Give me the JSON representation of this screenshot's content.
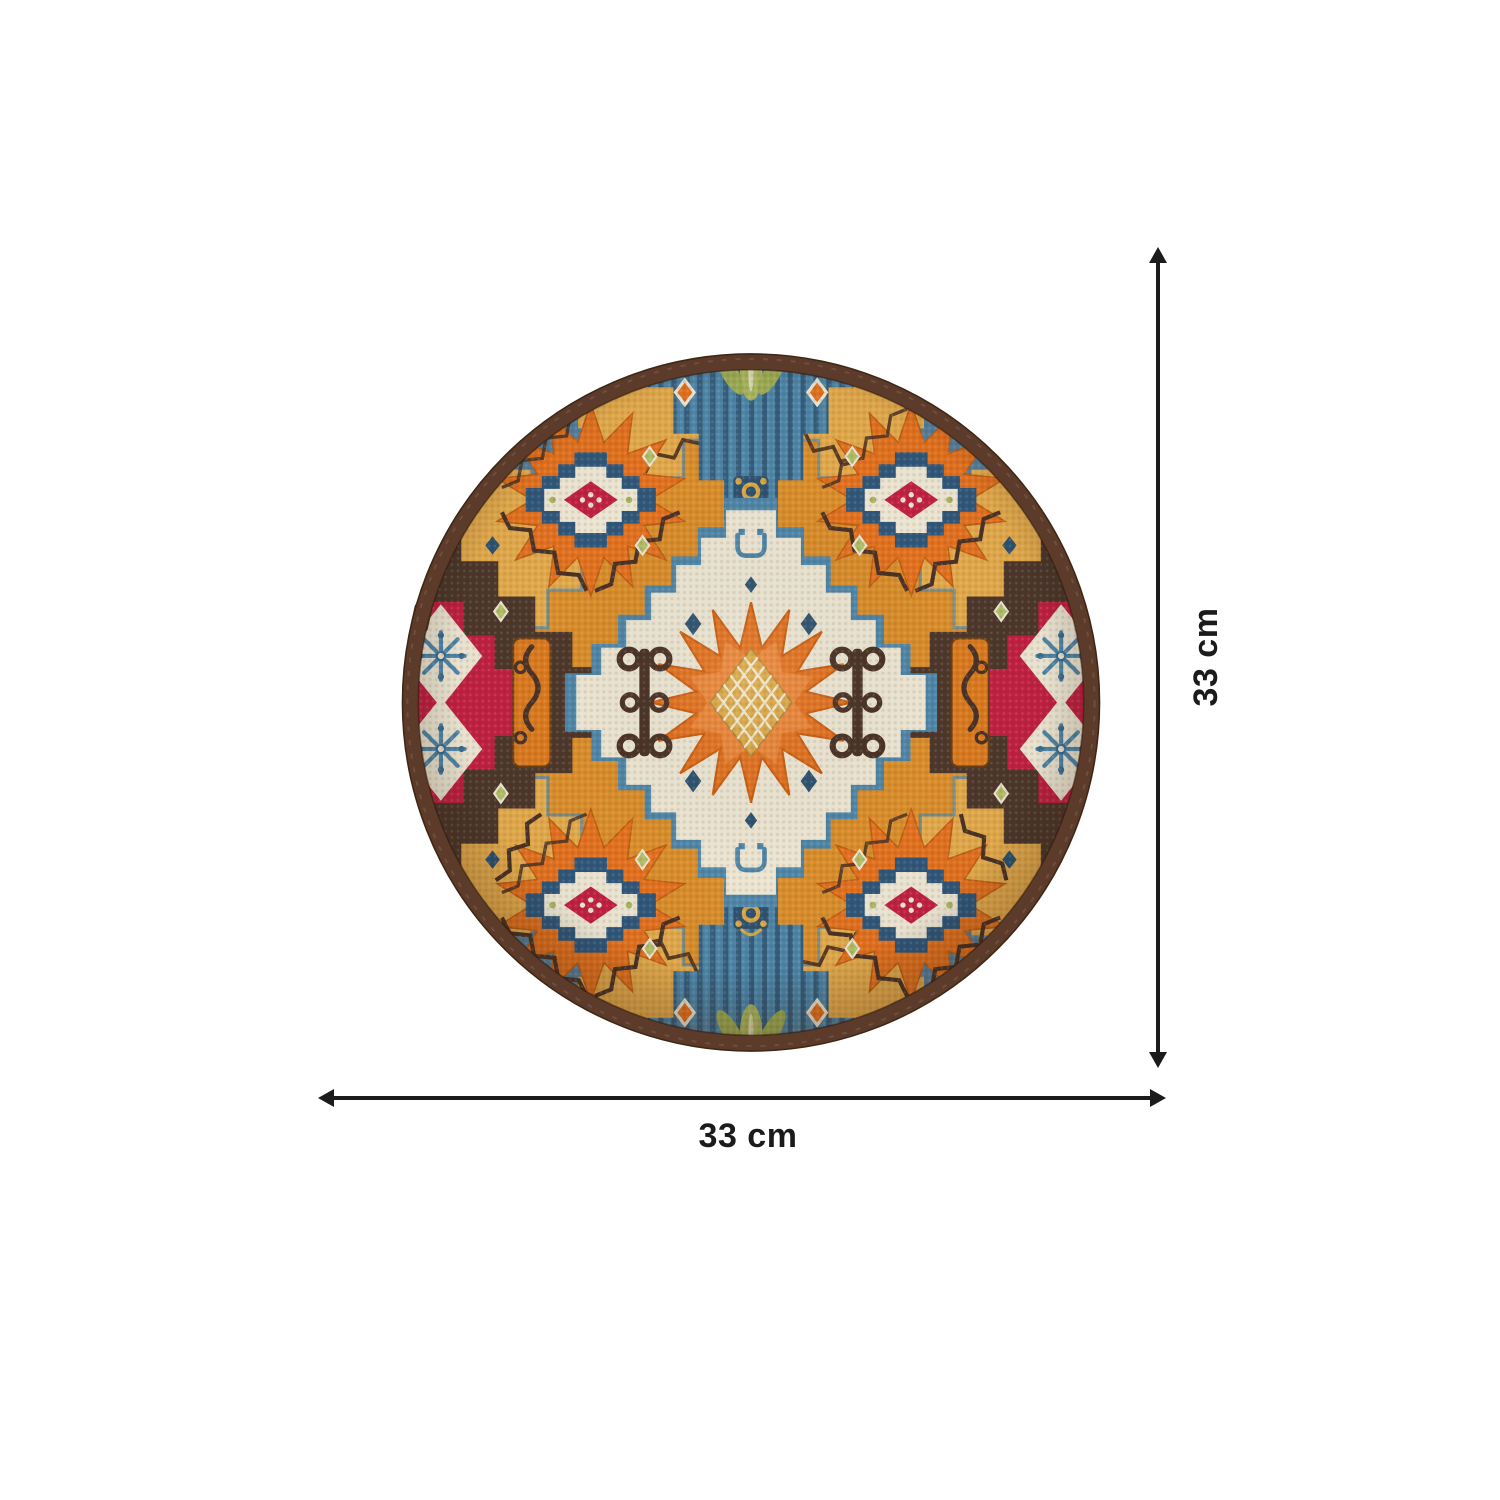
{
  "dimensions": {
    "height": {
      "label": "33 cm"
    },
    "width": {
      "label": "33 cm"
    }
  },
  "placemat": {
    "shape": "round",
    "palette": {
      "page_bg": "#ffffff",
      "dimension_color": "#1b1b1b",
      "trim_brown": "#5d3b2a",
      "trim_brown_dark": "#3f2715",
      "ground_mustard": "#e2a94b",
      "ground_gold": "#d98d2b",
      "orange": "#e2711f",
      "orange_deep": "#d9791f",
      "crimson": "#c12042",
      "brown_motif": "#4d372b",
      "brown_dark": "#4a3226",
      "steel_blue": "#4f86a8",
      "navy": "#2e5270",
      "slate": "#7e9cb5",
      "cream": "#ece5d2",
      "olive": "#a9b55e",
      "olive_light": "#b2bd66",
      "gold_center": "#d9a644"
    }
  }
}
